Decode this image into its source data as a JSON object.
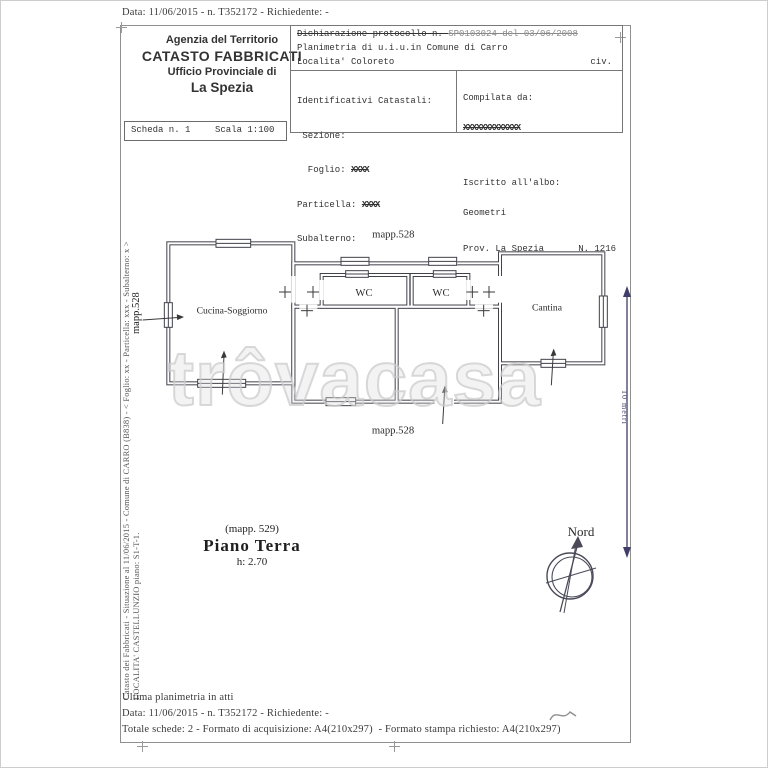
{
  "document": {
    "top_line": "Data: 11/06/2015 - n. T352172 - Richiedente: -",
    "office": {
      "l1": "Agenzia del Territorio",
      "l2": "CATASTO FABBRICATI",
      "l3": "Ufficio Provinciale di",
      "l4": "La Spezia"
    },
    "scheda_label": "Scheda n. 1",
    "scala_label": "Scala 1:100",
    "declaration": {
      "protocol_label": "Dichiarazione protocollo n. ",
      "protocol_value": "SP0103024 del 03/06/2008",
      "line2": "Planimetria di u.i.u.in Comune di Carro",
      "line3": "Localita' Coloreto",
      "civ": "civ."
    },
    "identificativi": {
      "title": "Identificativi Catastali:",
      "sezione": " Sezione:",
      "foglio_label": "  Foglio: ",
      "foglio_value": "XXXX",
      "particella_label": "Particella: ",
      "particella_value": "XXXX",
      "subalterno": "Subalterno:"
    },
    "compilata": {
      "label": "Compilata da:",
      "name": "XXXXXXXXXXXXX",
      "albo_label": "Iscritto all'albo:",
      "albo_value": "Geometri",
      "prov": "Prov. La Spezia",
      "numero": "N. 1216"
    },
    "footer": {
      "l1": "Ultima planimetria in atti",
      "l2": "Data: 11/06/2015 - n. T352172 - Richiedente: -",
      "l3": "Totale schede: 2 - Formato di acquisizione: A4(210x297)  - Formato stampa richiesto: A4(210x297)"
    }
  },
  "margins": {
    "left_l1": "Catasto dei Fabbricati - Situazione al 11/06/2015 - Comune di CARRO (B838) - < Foglio: xx - Particella: xxx - Subalterno: x >",
    "left_l2": "LOCALITA' CASTELLUNZIO piano: S1-T-1.",
    "left_mapp": "mapp.528",
    "scalebar_label": "10 metri"
  },
  "plan": {
    "mapp_top": "mapp.528",
    "mapp_bottom": "mapp.528",
    "room_cucina": "Cucina-Soggiorno",
    "room_wc1": "WC",
    "room_wc2": "WC",
    "room_cantina": "Cantina",
    "note_mapp": "(mapp. 529)",
    "floor_title": "Piano Terra",
    "floor_height": "h: 2.70",
    "compass_label": "Nord"
  },
  "watermark": "trôvacasa",
  "colors": {
    "ink": "#2e2e2e",
    "plan_line": "#41414b",
    "scalebar_navy": "#3e3e68",
    "frame_gray": "#909090",
    "watermark_gray": "#d9d9d9"
  }
}
